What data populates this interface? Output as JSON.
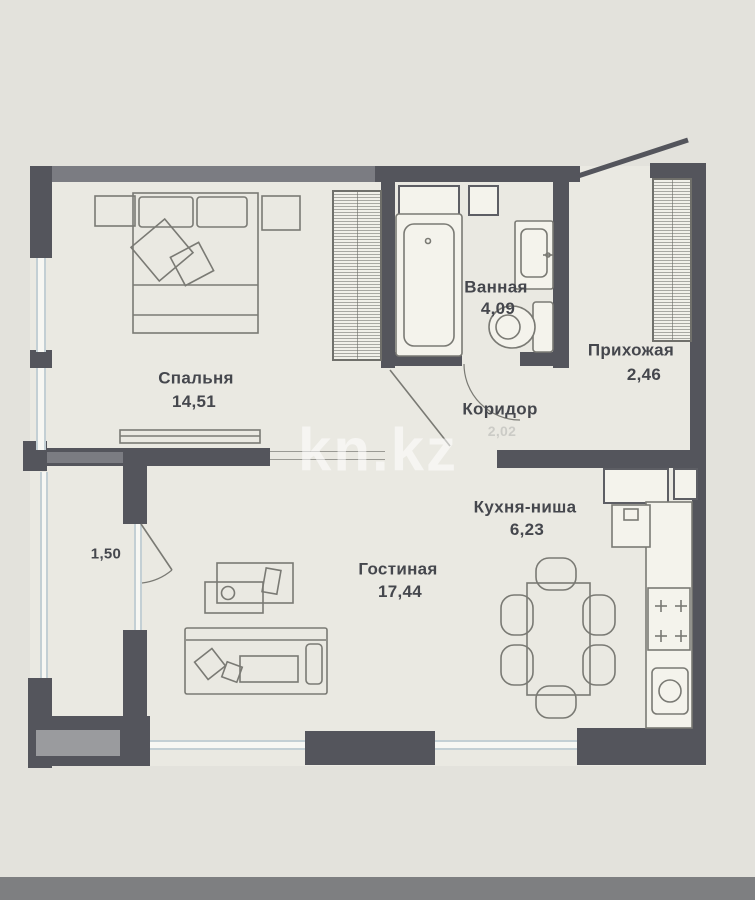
{
  "watermark": {
    "text": "kn.kz"
  },
  "rooms": {
    "bedroom": {
      "label": "Спальня",
      "area": "14,51"
    },
    "bathroom": {
      "label": "Ванная",
      "area": "4,09"
    },
    "hallway": {
      "label": "Прихожая",
      "area": "2,46"
    },
    "corridor": {
      "label": "Коридор",
      "area": "2,02"
    },
    "kitchen": {
      "label": "Кухня-ниша",
      "area": "6,23"
    },
    "living": {
      "label": "Гостиная",
      "area": "17,44"
    },
    "balcony": {
      "area": "1,50"
    }
  },
  "colors": {
    "wall": "#54555c",
    "wall_light": "#7b7c82",
    "floor": "#eae9e2",
    "background": "#e3e2dc",
    "window": "#c3cfd4",
    "furniture": "#7a7a74",
    "text": "#45474d",
    "bottom_bar": "#7e7f81"
  }
}
